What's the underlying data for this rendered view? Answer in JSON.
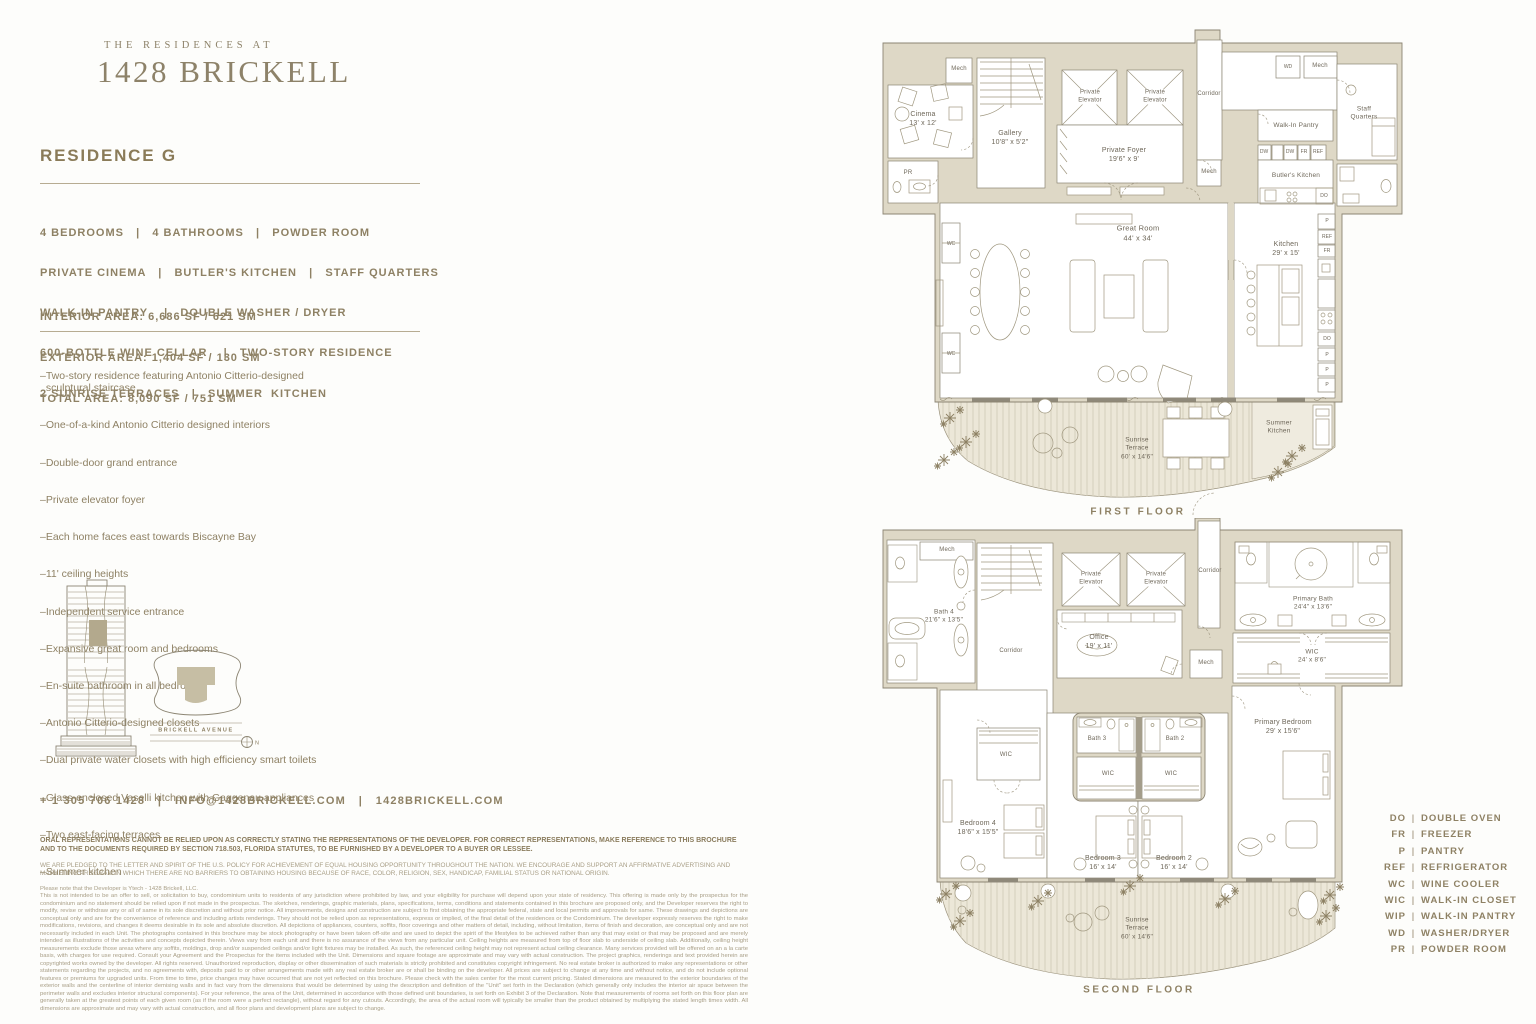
{
  "brand": {
    "eyebrow": "THE RESIDENCES AT",
    "title": "1428 BRICKELL"
  },
  "residence": {
    "title": "RESIDENCE G",
    "spec_lines": [
      "4 BEDROOMS   |   4 BATHROOMS   |   POWDER ROOM",
      "PRIVATE CINEMA   |   BUTLER'S KITCHEN   |   STAFF QUARTERS",
      "WALK-IN PANTRY    |   DOUBLE WASHER / DRYER",
      "600-BOTTLE WINE CELLAR    |   TWO-STORY RESIDENCE",
      "2 SUNRISE TERRACES   |   SUMMER  KITCHEN"
    ],
    "area_lines": [
      "INTERIOR AREA: 6,686 SF / 621 SM",
      "EXTERIOR AREA: 1,404 SF / 130 SM",
      "TOTAL AREA: 8,090 SF / 751 SM"
    ]
  },
  "features": [
    "–Two-story residence featuring Antonio Citterio-designed\n  sculptural staircase",
    "–One-of-a-kind Antonio Citterio designed interiors",
    "–Double-door grand entrance",
    "–Private elevator foyer",
    "–Each home faces east towards Biscayne Bay",
    "–11' ceiling heights",
    "–Independent service entrance",
    "–Expansive great room and bedrooms",
    "–En-suite bathroom in all bedrooms",
    "–Antonio Citterio-designed closets",
    "–Dual private water closets with high efficiency smart toilets",
    "–Glass-enclosed Vaselli kitchen with Gaggenau appliances",
    "–Two east-facing terraces",
    "–Summer kitchen"
  ],
  "locator": {
    "street": "BRICKELL AVENUE",
    "north": "N"
  },
  "contact": "+ 1 305 706 1428   |   INFO@1428BRICKELL.COM   |   1428BRICKELL.COM",
  "legal": {
    "bold": "ORAL REPRESENTATIONS CANNOT BE RELIED UPON AS CORRECTLY STATING THE REPRESENTATIONS OF THE DEVELOPER. FOR CORRECT REPRESENTATIONS, MAKE REFERENCE TO THIS BROCHURE AND TO THE DOCUMENTS REQUIRED BY SECTION 718.503, FLORIDA STATUTES, TO BE FURNISHED BY A DEVELOPER TO A BUYER OR LESSEE.",
    "equal_housing": "WE ARE PLEDGED TO THE LETTER AND SPIRIT OF THE U.S. POLICY FOR ACHIEVEMENT OF EQUAL HOUSING OPPORTUNITY THROUGHOUT THE NATION. WE ENCOURAGE AND SUPPORT AN AFFIRMATIVE ADVERTISING AND MARKETING PROGRAM IN WHICH THERE ARE NO BARRIERS TO OBTAINING HOUSING BECAUSE OF RACE, COLOR, RELIGION, SEX, HANDICAP, FAMILIAL STATUS OR NATIONAL ORIGIN.",
    "intro": "Please note that the Developer is Ytech - 1428 Brickell, LLC.",
    "body": "This is not intended to be an offer to sell, or solicitation to buy, condominium units to residents of any jurisdiction where prohibited by law, and your eligibility for purchase will depend upon your state of residency. This offering is made only by the prospectus for the condominium and no statement should be relied upon if not made in the prospectus. The sketches, renderings, graphic materials, plans, specifications, terms, conditions and statements contained in this brochure are proposed only, and the Developer reserves the right to modify, revise or withdraw any or all of same in its sole discretion and without prior notice. All improvements, designs and construction are subject to first obtaining the appropriate federal, state and local permits and approvals for same. These drawings and depictions are conceptual only and are for the convenience of reference and including artists renderings. They should not be relied upon as representations, express or implied, of the final detail of the residences or the Condominium. The developer expressly reserves the right to make modifications, revisions, and changes it deems desirable in its sole and absolute discretion. All depictions of appliances, counters, soffits, floor coverings and other matters of detail, including, without limitation, items of finish and decoration, are conceptual only and are not necessarily included in each Unit. The photographs contained in this brochure may be stock photography or have been taken off-site and are used to depict the spirit of the lifestyles to be achieved rather than any that may exist or that may be proposed and are merely intended as illustrations of the activities and concepts depicted therein. Views vary from each unit and there is no assurance of the views from any particular unit. Ceiling heights are measured from top of floor slab to underside of ceiling slab. Additionally, ceiling height measurements exclude those areas where any soffits, moldings, drop and/or suspended ceilings and/or light fixtures may be installed. As such, the referenced ceiling height may not represent actual ceiling clearance. Many services provided will be offered on an a la carte basis, with charges for use required. Consult your Agreement and the Prospectus for the items included with the Unit. Dimensions and square footage are approximate and may vary with actual construction. The project graphics, renderings and text provided herein are copyrighted works owned by the developer. All rights reserved. Unauthorized reproduction, display or other dissemination of such materials is strictly prohibited and constitutes copyright infringement. No real estate broker is authorized to make any representations or other statements regarding the projects, and no agreements with, deposits paid to or other arrangements made with any real estate broker are or shall be binding on the developer. All prices are subject to change at any time and without notice, and do not include optional features or premiums for upgraded units. From time to time, price changes may have occurred that are not yet reflected on this brochure. Please check with the sales center for the most current pricing. Stated dimensions are measured to the exterior boundaries of the exterior walls and the centerline of interior demising walls and in fact vary from the dimensions that would be determined by using the description and definition of the \"Unit\" set forth in the Declaration (which generally only includes the interior air space between the perimeter walls and excludes interior structural components). For your reference, the area of the Unit, determined in accordance with those defined unit boundaries, is set forth on Exhibit 3 of the Declaration. Note that measurements of rooms set forth on this floor plan are generally taken at the greatest points of each given room (as if the room were a perfect rectangle), without regard for any cutouts. Accordingly, the area of the actual room will typically be smaller than the product obtained by multiplying the stated length times width. All dimensions are approximate and may vary with actual construction, and all floor plans and development plans are subject to change."
  },
  "legend": {
    "divider": "|",
    "rows": [
      {
        "abbr": "DO",
        "label": "DOUBLE OVEN"
      },
      {
        "abbr": "FR",
        "label": "FREEZER"
      },
      {
        "abbr": "P",
        "label": "PANTRY"
      },
      {
        "abbr": "REF",
        "label": "REFRIGERATOR"
      },
      {
        "abbr": "WC",
        "label": "WINE COOLER"
      },
      {
        "abbr": "WIC",
        "label": "WALK-IN CLOSET"
      },
      {
        "abbr": "WIP",
        "label": "WALK-IN PANTRY"
      },
      {
        "abbr": "WD",
        "label": "WASHER/DRYER"
      },
      {
        "abbr": "PR",
        "label": "POWDER ROOM"
      }
    ]
  },
  "floors": {
    "first": {
      "caption": "FIRST FLOOR",
      "rooms": {
        "cinema": "Cinema\n13' x 12'",
        "mech_a": "Mech",
        "pr": "PR",
        "gallery": "Gallery\n10'8\" x 5'2\"",
        "elevator_a": "Private\nElevator",
        "elevator_b": "Private\nElevator",
        "foyer": "Private Foyer\n19'6\" x 9'",
        "corridor": "Corridor",
        "wd": "WD",
        "mech_b": "Mech",
        "pantry": "Walk-In Pantry",
        "staff": "Staff\nQuarters",
        "dw_a": "DW",
        "dw_b": "DW",
        "fr_a": "FR",
        "ref_a": "REF",
        "butlers": "Butler's Kitchen",
        "do_a": "DO",
        "mech_c": "Mech",
        "great_room": "Great Room\n44' x 34'",
        "wc_a": "WC",
        "wc_b": "WC",
        "kitchen": "Kitchen\n29' x 15'",
        "p_a": "P",
        "ref_b": "REF",
        "fr_b": "FR",
        "do_b": "DO",
        "p_b": "P",
        "p_c": "P",
        "p_d": "P",
        "summer_kitchen": "Summer\nKitchen",
        "terrace": "Sunrise\nTerrace\n60' x 14'6\""
      }
    },
    "second": {
      "caption": "SECOND FLOOR",
      "rooms": {
        "mech_a": "Mech",
        "bath4": "Bath 4\n21'6\" x 13'5\"",
        "corridor_a": "Corridor",
        "elevator_a": "Private\nElevator",
        "elevator_b": "Private\nElevator",
        "office": "Office\n19' x 11'",
        "corridor_b": "Corridor",
        "mech_b": "Mech",
        "primary_bath": "Primary Bath\n24'4\" x 13'6\"",
        "wic_primary": "WIC\n24' x 8'6\"",
        "primary_bedroom": "Primary Bedroom\n29' x 15'6\"",
        "wic_4": "WIC",
        "bath3": "Bath 3",
        "bath2": "Bath 2",
        "wic_3": "WIC",
        "wic_2": "WIC",
        "bedroom4": "Bedroom 4\n18'6\" x 15'5\"",
        "bedroom3": "Bedroom 3\n16' x 14'",
        "bedroom2": "Bedroom 2\n16' x 14'",
        "terrace": "Sunrise\nTerrace\n60' x 14'6\""
      }
    }
  }
}
